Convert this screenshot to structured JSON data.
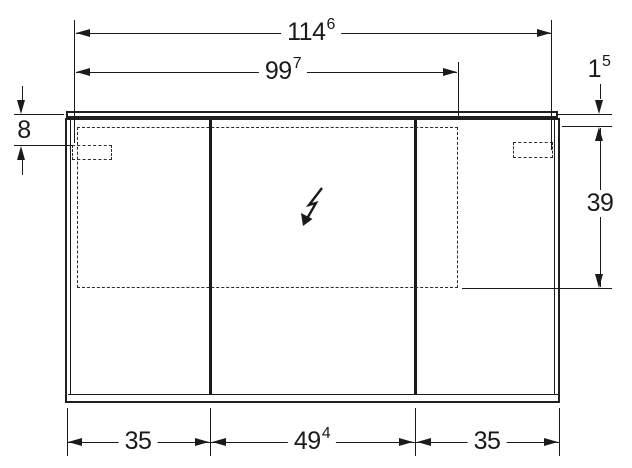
{
  "drawing": {
    "description": "mirror-cabinet-dimension-diagram",
    "line_color": "#1a1a1a",
    "background_color": "#ffffff"
  },
  "icons": {
    "power_symbol": "electrical-connection-arrow-icon"
  },
  "dims": {
    "total_width": {
      "main": "114",
      "sup": "6"
    },
    "inner_width": {
      "main": "99",
      "sup": "7"
    },
    "profile_height": {
      "main": "1",
      "sup": "5"
    },
    "top_offset": {
      "main": "8",
      "sup": ""
    },
    "niche_height": {
      "main": "39",
      "sup": ""
    },
    "door_left": {
      "main": "35",
      "sup": ""
    },
    "door_middle": {
      "main": "49",
      "sup": "4"
    },
    "door_right": {
      "main": "35",
      "sup": ""
    }
  }
}
